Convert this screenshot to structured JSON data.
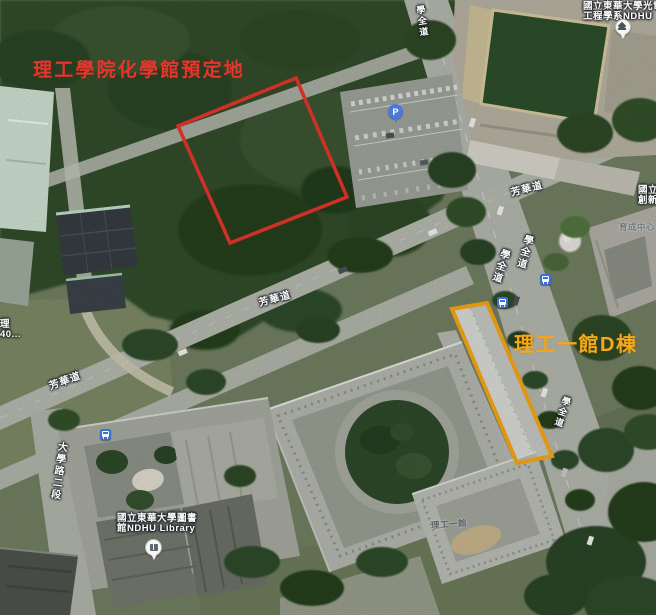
{
  "annotations": {
    "planned_site": {
      "label": "理工學院化學館預定地",
      "color": "#e8352b"
    },
    "building_d": {
      "label": "理工一館D棟",
      "color": "#f7a717"
    }
  },
  "road_labels": [
    {
      "id": "fanghua-west",
      "name": "芳華道"
    },
    {
      "id": "fanghua-center",
      "name": "芳華道"
    },
    {
      "id": "fanghua-east",
      "name": "芳華道"
    },
    {
      "id": "xuequan-north",
      "name": "學全道"
    },
    {
      "id": "xuequan-mid-west",
      "name": "學全道"
    },
    {
      "id": "xuequan-mid-east",
      "name": "學全道"
    },
    {
      "id": "xuequan-south",
      "name": "學全道"
    },
    {
      "id": "daxue-road-sec2",
      "name": "大學路二段"
    }
  ],
  "poi_labels": {
    "optoelectronics": {
      "line1": "國立東華大學光電",
      "line2": "工程學系NDHU"
    },
    "incubation": {
      "line1": "國立",
      "line2": "創新"
    },
    "incubation_building": "育成中心",
    "library": {
      "line1": "國立東華大學圖書",
      "line2": "館NDHU Library"
    },
    "sci_eng_hall_1": "理工一館",
    "edge_clipped": {
      "line1": "理",
      "line2": "40..."
    }
  },
  "icons": {
    "parking_pin": {
      "glyph": "P",
      "color": "#4a79d9"
    },
    "bus_stop_color": "#3b6fd6"
  },
  "colors": {
    "annotation_red": "#e8352b",
    "annotation_amber": "#f7a717",
    "road_gray": "#b4b8ae",
    "forest_green": "#314d2c",
    "lawn_green": "#728062"
  }
}
